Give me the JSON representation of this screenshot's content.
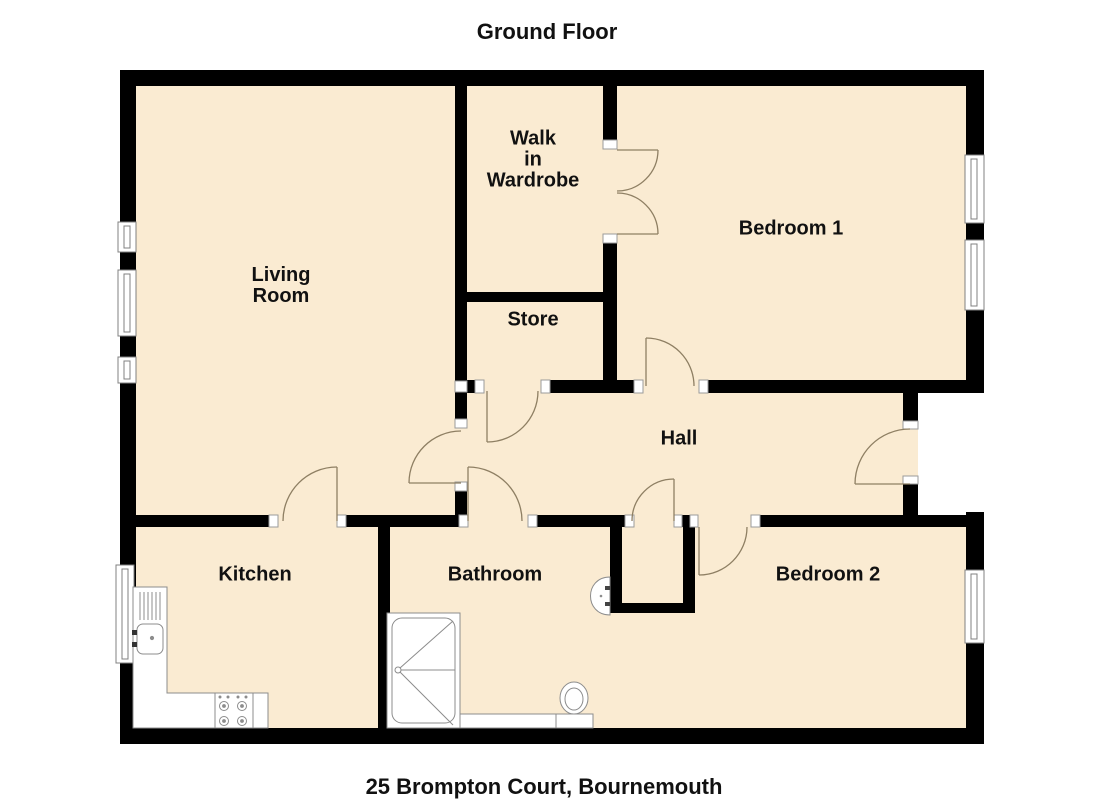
{
  "header": {
    "title": "Ground Floor"
  },
  "footer": {
    "address": "25 Brompton Court, Bournemouth"
  },
  "floorplan": {
    "rooms": [
      {
        "id": "living-room",
        "label": "Living\nRoom"
      },
      {
        "id": "walk-in-wardrobe",
        "label": "Walk\nin\nWardrobe"
      },
      {
        "id": "bedroom-1",
        "label": "Bedroom 1"
      },
      {
        "id": "store",
        "label": "Store"
      },
      {
        "id": "hall",
        "label": "Hall"
      },
      {
        "id": "kitchen",
        "label": "Kitchen"
      },
      {
        "id": "bathroom",
        "label": "Bathroom"
      },
      {
        "id": "bedroom-2",
        "label": "Bedroom 2"
      }
    ],
    "fixtures": [
      "bath",
      "toilet",
      "wash-basin",
      "sink-with-drainer",
      "hob",
      "kitchen-counter"
    ],
    "windows_count": 7,
    "doors_count": 9,
    "colors": {
      "floor": "#faebd2",
      "wall": "#000000",
      "door_arc": "#8e7f63",
      "window_frame": "#808080",
      "fixture_outline": "#8c8c8c",
      "text": "#111111",
      "background": "#ffffff"
    }
  }
}
